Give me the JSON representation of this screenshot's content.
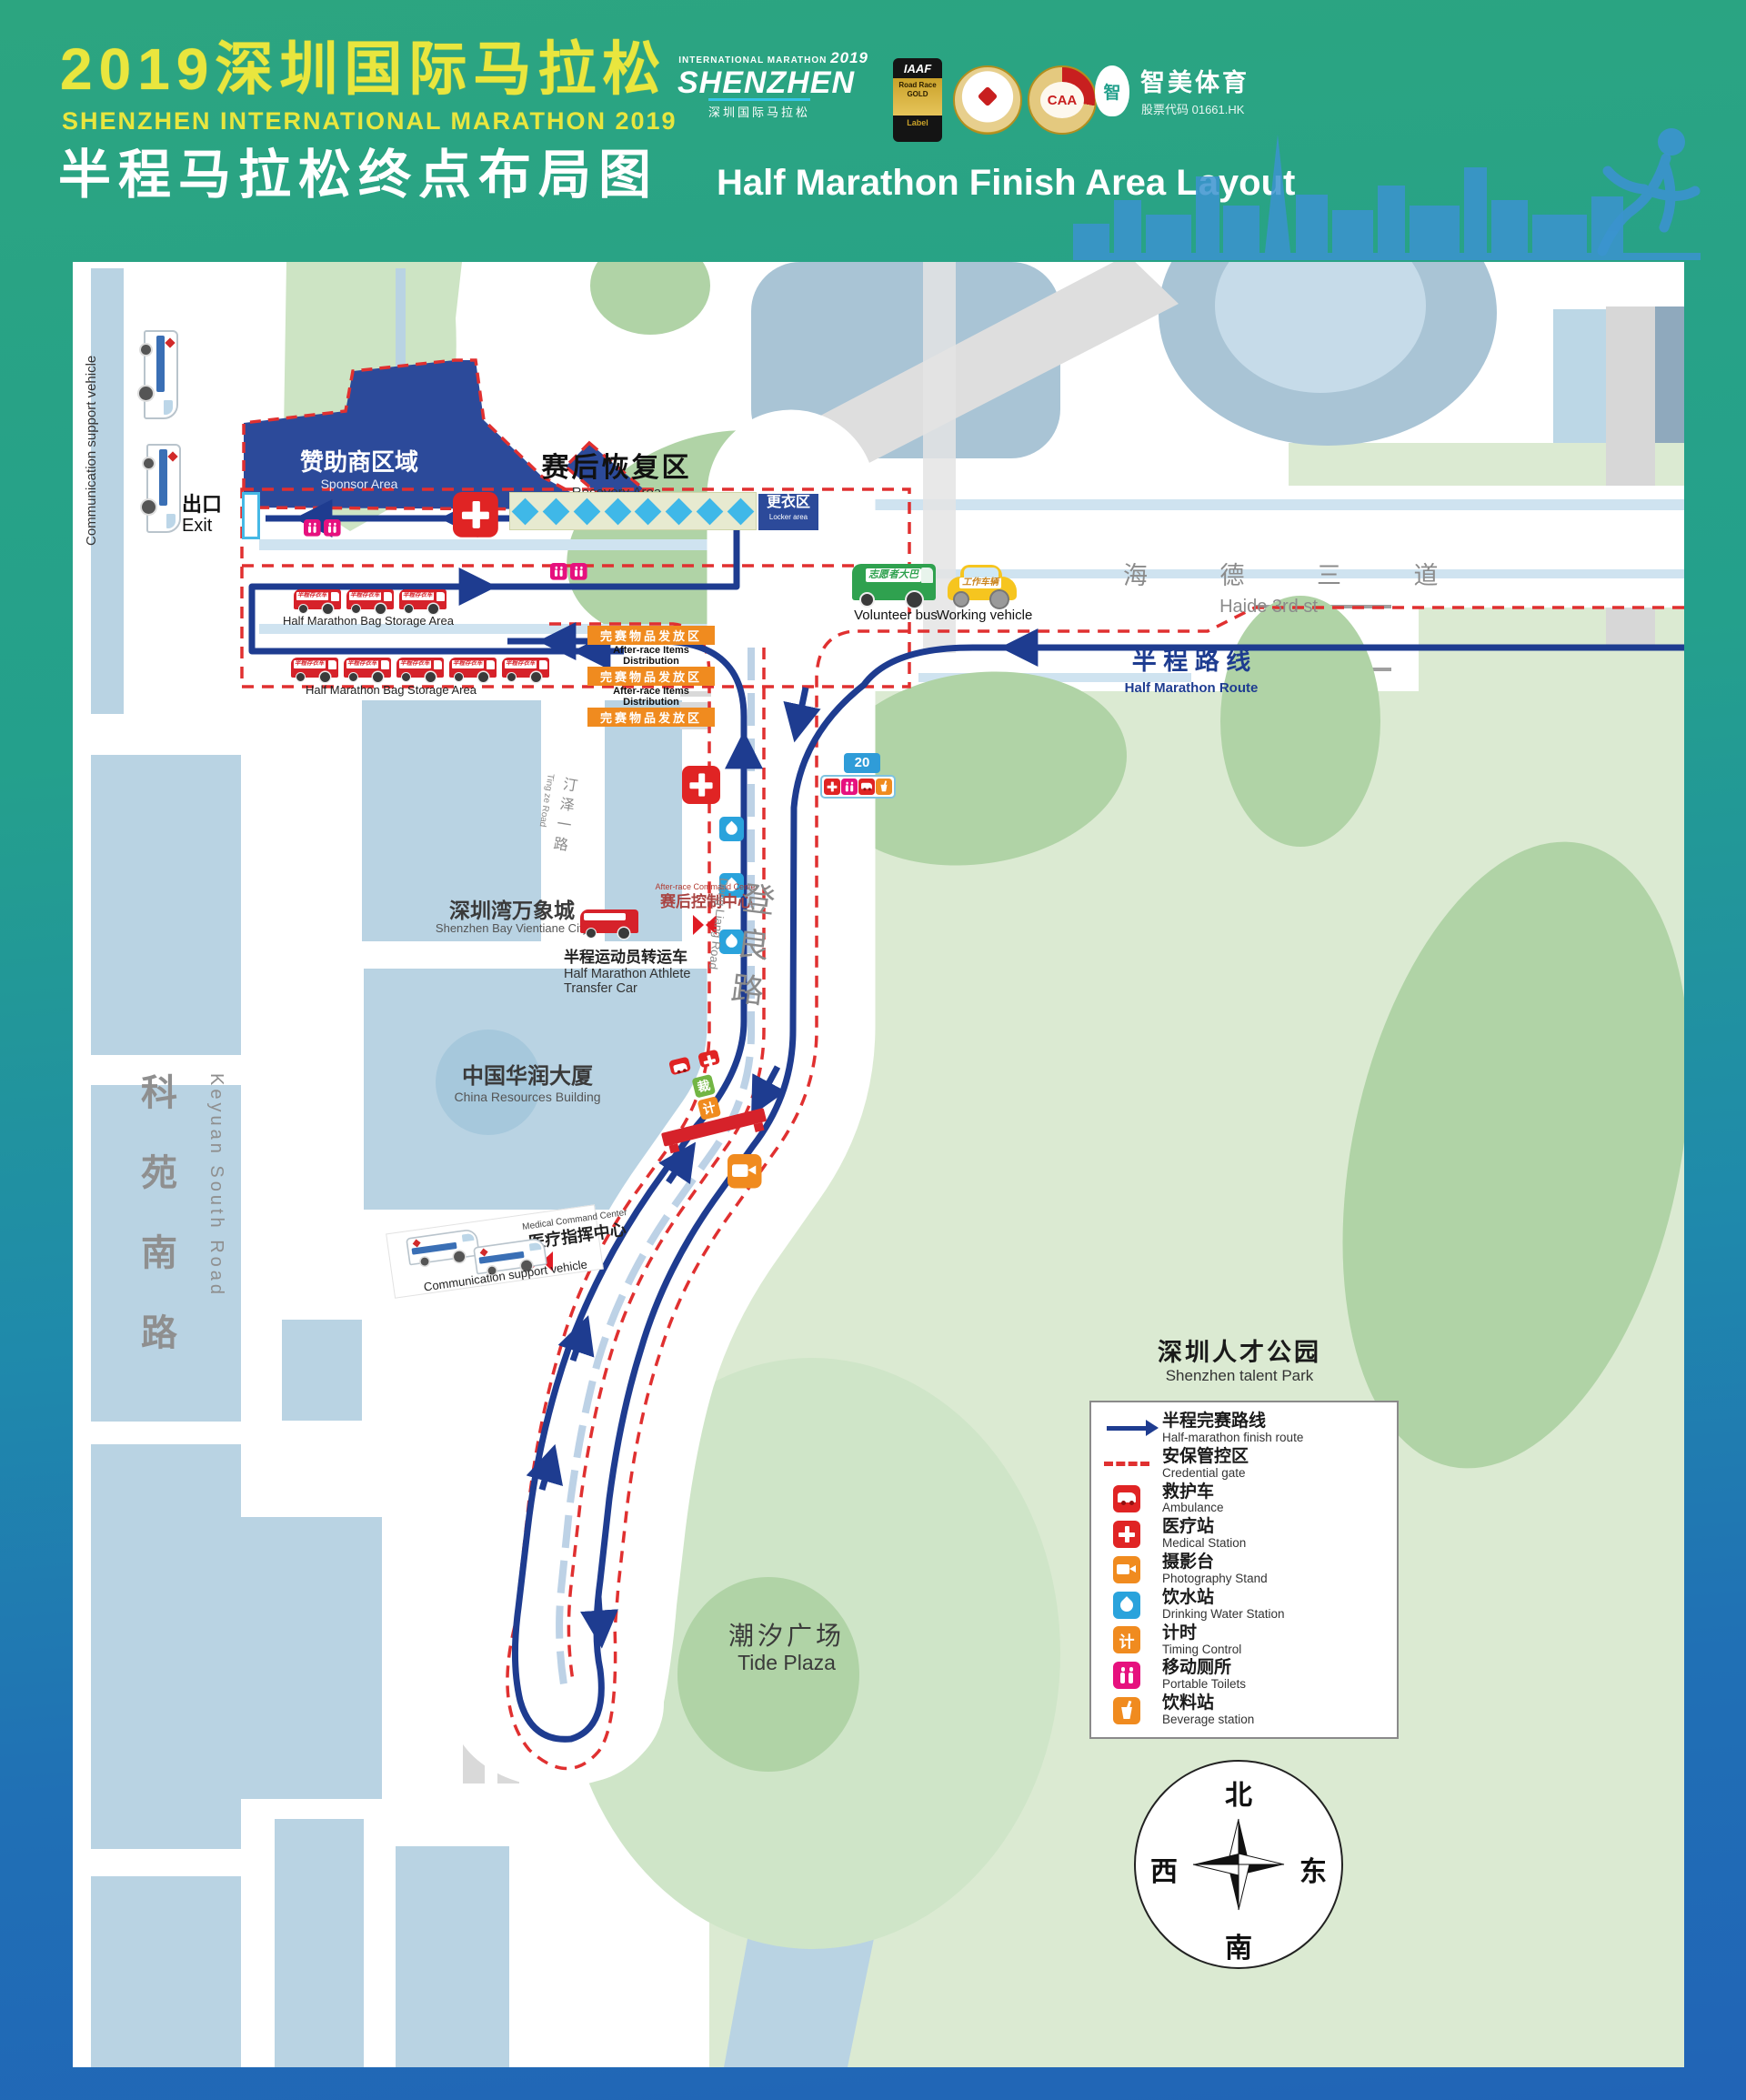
{
  "header": {
    "title_zh": "2019深圳国际马拉松",
    "title_en": "SHENZHEN INTERNATIONAL MARATHON 2019",
    "subtitle_zh": "半程马拉松终点布局图",
    "subtitle_en": "Half Marathon Finish Area Layout",
    "logo": {
      "intl": "INTERNATIONAL MARATHON",
      "year": "2019",
      "name_en": "SHENZHEN",
      "name_zh": "深圳国际马拉松"
    },
    "iaaf": {
      "top": "IAAF",
      "mid": "Road Race GOLD",
      "bottom": "Label"
    },
    "caa": "CAA",
    "zhimei": {
      "icon_char": "智",
      "name": "智美体育",
      "stock": "股票代码 01661.HK"
    }
  },
  "map": {
    "comm_vehicle_label": "Communication support vehicle",
    "sponsor": {
      "zh": "赞助商区域",
      "en": "Sponsor Area"
    },
    "recovery": {
      "zh": "赛后恢复区",
      "en": "Recovery Area"
    },
    "locker": {
      "zh": "更衣区",
      "en": "Locker area"
    },
    "exit": {
      "zh": "出口",
      "en": "Exit"
    },
    "bag_storage_en": "Half Marathon Bag Storage Area",
    "bus_sign": "半程存衣车",
    "distribution": {
      "zh": "完赛物品发放区",
      "en": "After-race Items Distribution"
    },
    "volunteer": {
      "zh": "志愿者大巴",
      "en": "Volunteer bus"
    },
    "working": {
      "zh": "工作车辆",
      "en": "Working vehicle"
    },
    "haide": {
      "zh": "海 德 三 道",
      "en": "Haide 3rd st"
    },
    "half_route": {
      "zh": "半 程 路 线",
      "en": "Half Marathon Route"
    },
    "km_marker": "20",
    "vientiane": {
      "zh": "深圳湾万象城",
      "en": "Shenzhen Bay Vientiane City"
    },
    "tingze": {
      "zh": "汀泽一路",
      "en": "Ting ze Road"
    },
    "command_center": {
      "zh": "赛后控制中心",
      "en": "After-race Command Center"
    },
    "transfer": {
      "zh": "半程运动员转运车",
      "en": "Half Marathon Athlete Transfer Car"
    },
    "dengliang": {
      "zh": "登良路",
      "en": "Deng Liang Road"
    },
    "huarun": {
      "zh": "中国华润大厦",
      "en": "China Resources Building"
    },
    "medical_command": {
      "zh": "医疗指挥中心",
      "en": "Medical Command Center"
    },
    "keyuan": {
      "zh": "科苑南路",
      "en": "Keyuan South Road"
    },
    "talent_park": {
      "zh": "深圳人才公园",
      "en": "Shenzhen talent Park"
    },
    "tide": {
      "zh": "潮汐广场",
      "en": "Tide Plaza"
    },
    "gate": {
      "referee": "裁",
      "timing": "计"
    }
  },
  "legend": {
    "items": [
      {
        "type": "route-arrow",
        "zh": "半程完赛路线",
        "en": "Half-marathon finish route"
      },
      {
        "type": "credential-dash",
        "zh": "安保管控区",
        "en": "Credential gate"
      },
      {
        "type": "ambulance",
        "zh": "救护车",
        "en": "Ambulance"
      },
      {
        "type": "medical",
        "zh": "医疗站",
        "en": "Medical Station"
      },
      {
        "type": "photography",
        "zh": "摄影台",
        "en": "Photography Stand"
      },
      {
        "type": "water",
        "zh": "饮水站",
        "en": "Drinking Water Station"
      },
      {
        "type": "timing",
        "zh": "计时",
        "en": "Timing Control",
        "char": "计"
      },
      {
        "type": "toilets",
        "zh": "移动厕所",
        "en": "Portable Toilets"
      },
      {
        "type": "beverage",
        "zh": "饮料站",
        "en": "Beverage station"
      }
    ]
  },
  "compass": {
    "n": "北",
    "s": "南",
    "e": "东",
    "w": "西"
  },
  "colors": {
    "route": "#1e3c90",
    "credential": "#e03030",
    "sponsor": "#2c4a9a",
    "orange": "#f08b1f",
    "magenta": "#e6117e",
    "water": "#2aa3dc",
    "title_yellow": "#e9e63e"
  }
}
